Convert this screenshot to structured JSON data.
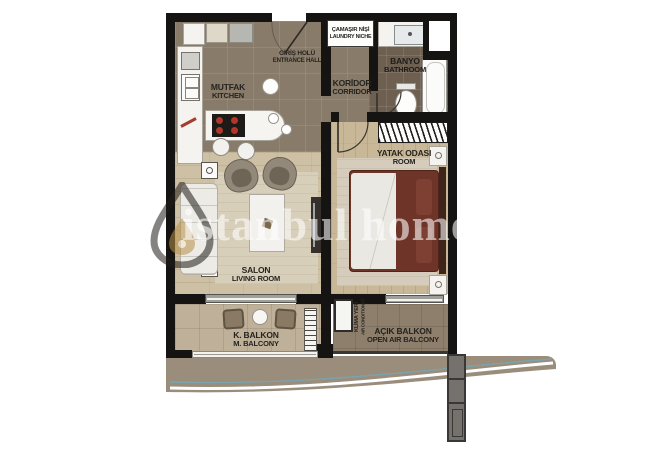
{
  "plan": {
    "watermark": "istanbul home",
    "rooms": {
      "kitchen": {
        "tr": "MUTFAK",
        "en": "KITCHEN"
      },
      "entrance_hall": {
        "tr": "GİRİŞ HOLÜ",
        "en": "ENTRANCE HALL"
      },
      "laundry_niche": {
        "tr": "ÇAMAŞIR NİŞİ",
        "en": "LAUNDRY NICHE"
      },
      "corridor": {
        "tr": "KORİDOR",
        "en": "CORRIDOR"
      },
      "bathroom": {
        "tr": "BANYO",
        "en": "BATHROOM"
      },
      "bedroom": {
        "tr": "YATAK ODASI",
        "en": "ROOM"
      },
      "living_room": {
        "tr": "SALON",
        "en": "LIVING ROOM"
      },
      "balcony": {
        "tr": "K. BALKON",
        "en": "M. BALCONY"
      },
      "open_balcony": {
        "tr": "AÇIK BALKON",
        "en": "OPEN AIR BALCONY"
      },
      "ac_unit": {
        "tr": "KLİMA YERİ",
        "en": "AIR CONDITIONER"
      }
    },
    "colors": {
      "wall": "#161412",
      "tile_brown": "#897b6a",
      "tile_dark": "#6e6051",
      "wood_light": "#cec0a4",
      "wood_bedroom": "#c9b897",
      "balcony_tile": "#bfb199",
      "open_balcony_tile": "#8d7f6c",
      "terrace_band": "#9a8d7b",
      "bed_cover": "#6b3226",
      "terrace_accent": "#7ba3ad"
    }
  }
}
